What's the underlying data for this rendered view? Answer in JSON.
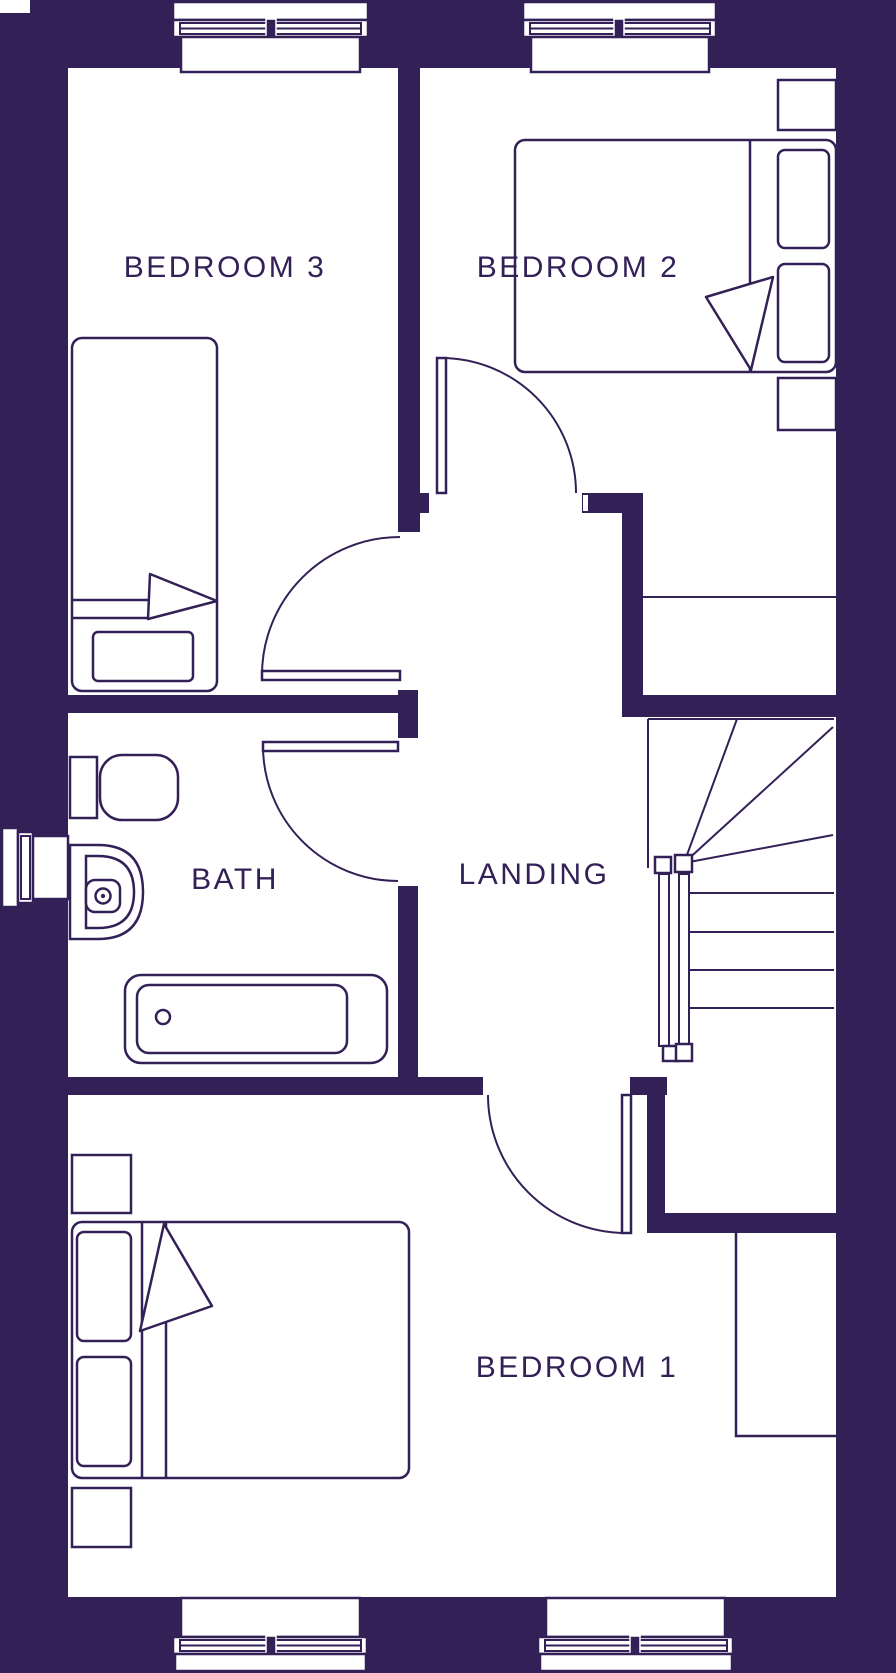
{
  "palette": {
    "wall": "#332057",
    "line": "#332057",
    "floor": "#ffffff"
  },
  "rooms": {
    "bedroom3": {
      "label": "BEDROOM 3"
    },
    "bedroom2": {
      "label": "BEDROOM 2"
    },
    "bath": {
      "label": "BATH"
    },
    "landing": {
      "label": "LANDING"
    },
    "bedroom1": {
      "label": "BEDROOM 1"
    }
  },
  "fixtures": {
    "bedroom3": [
      "single-bed",
      "pillow",
      "window"
    ],
    "bedroom2": [
      "double-bed",
      "two-pillows",
      "two-bedside-tables",
      "closet-shelf",
      "window"
    ],
    "bath": [
      "toilet",
      "basin",
      "bathtub",
      "side-window"
    ],
    "landing": [
      "staircase-with-handrails"
    ],
    "bedroom1": [
      "double-bed",
      "two-pillows",
      "two-bedside-tables",
      "wardrobe",
      "two-windows"
    ]
  }
}
